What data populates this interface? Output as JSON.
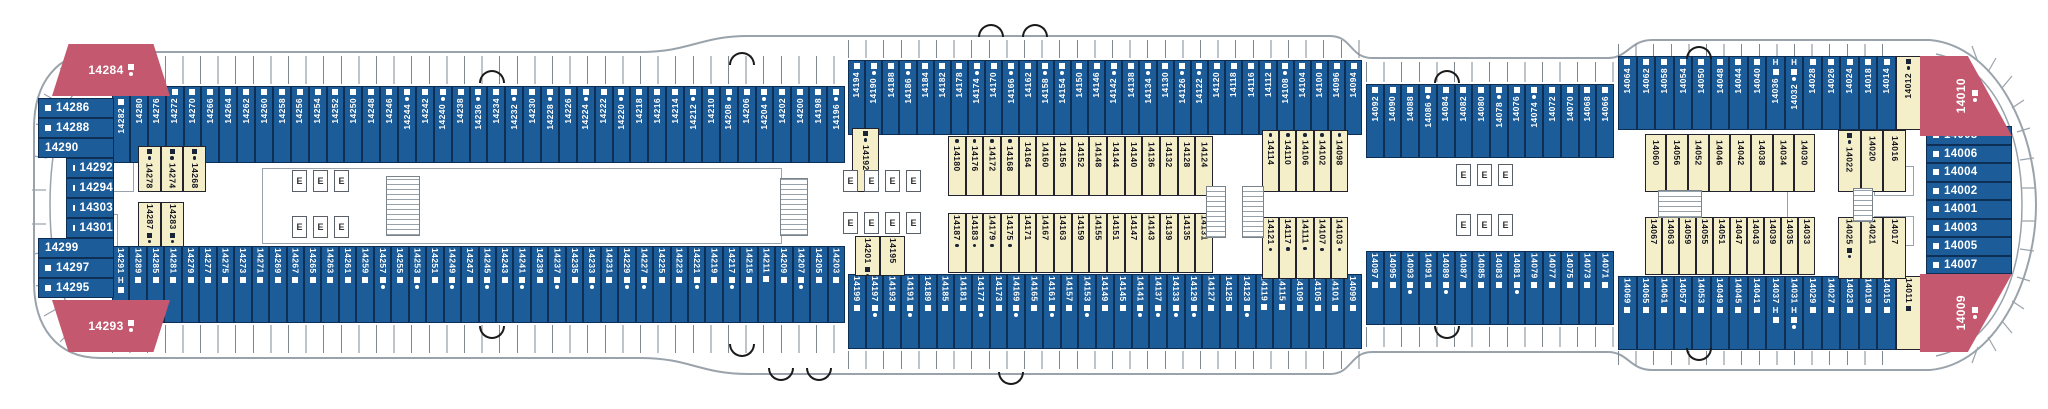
{
  "palette": {
    "cabin_blue": "#1c5c99",
    "cabin_inside_yellow": "#f4efc9",
    "suite_red": "#c4586f",
    "outline_gray": "#9aa3ab",
    "text_dark": "#14141e",
    "text_light": "#ffffff"
  },
  "deck": {
    "strips": [
      {
        "name": "top-outer-left-band",
        "x": 112,
        "y": 86,
        "w": 733,
        "h": 77,
        "orient": "v-up",
        "style": "blue",
        "mk": "start",
        "cells": [
          "14282|H",
          "14280",
          "14276",
          "14272",
          "14270",
          "14266",
          "14264",
          "14262",
          "14260",
          "14258",
          "14256",
          "14254",
          "14252",
          "14250",
          "14248",
          "14246",
          "14244|d",
          "14242",
          "14240|d",
          "14238",
          "14236|d",
          "14234",
          "14232|d",
          "14230",
          "14228|d",
          "14226",
          "14224|d",
          "14222",
          "14220|d",
          "14218",
          "14216",
          "14214",
          "14212|d",
          "14210",
          "14208|d",
          "14206",
          "14204|d",
          "14202",
          "14200",
          "14198",
          "14196|d"
        ]
      },
      {
        "name": "top-outer-mid-band",
        "x": 848,
        "y": 60,
        "w": 514,
        "h": 75,
        "orient": "v-up",
        "style": "blue",
        "mk": "start",
        "cells": [
          "14194",
          "14190|d",
          "14188",
          "14186|d",
          "14184",
          "14182",
          "14178",
          "14174|d",
          "14170",
          "14166|d",
          "14162",
          "14158|d",
          "14154|d",
          "14150",
          "14146",
          "14142|d",
          "14138",
          "14134|d",
          "14130",
          "14126|d",
          "14122|d",
          "14120",
          "14118",
          "14116",
          "14112",
          "14108|d",
          "14104",
          "14100",
          "14096",
          "14094"
        ]
      },
      {
        "name": "top-outer-narrow-band",
        "x": 1366,
        "y": 84,
        "w": 248,
        "h": 74,
        "orient": "v-up",
        "style": "blue",
        "mk": "start",
        "cells": [
          "14092",
          "14090",
          "14088",
          "14086|d",
          "14084",
          "14082",
          "14080",
          "14078|d",
          "14076",
          "14074|d",
          "14072",
          "14070",
          "14068",
          "14066"
        ]
      },
      {
        "name": "top-outer-fwd-band",
        "x": 1618,
        "y": 56,
        "w": 278,
        "h": 74,
        "orient": "v-up",
        "style": "blue",
        "mk": "start",
        "cells": [
          "14064",
          "14062",
          "14058",
          "14054",
          "14050",
          "14048",
          "14044",
          "14040",
          "14036|H",
          "14032|Hd",
          "14028",
          "14026",
          "14024",
          "14018",
          "14014"
        ]
      },
      {
        "name": "top-fwd-yellow-cabin",
        "x": 1896,
        "y": 56,
        "w": 25,
        "h": 74,
        "orient": "v-up",
        "style": "yellow",
        "mk": "start",
        "cells": [
          "14012|sd"
        ]
      },
      {
        "name": "top-inner-14192",
        "x": 852,
        "y": 128,
        "w": 27,
        "h": 64,
        "orient": "v-down",
        "style": "yellow",
        "mk": "start",
        "cells": [
          "14192|sd"
        ]
      },
      {
        "name": "top-inner-mid-a",
        "x": 948,
        "y": 136,
        "w": 265,
        "h": 60,
        "orient": "v-down",
        "style": "yellow",
        "mk": "start",
        "cells": [
          "14180|d",
          "14176|d",
          "14172|d",
          "14168|d",
          "14164",
          "14160",
          "14156",
          "14152",
          "14148",
          "14144",
          "14140",
          "14136",
          "14132",
          "14128",
          "14124"
        ]
      },
      {
        "name": "top-inner-mid-b",
        "x": 1262,
        "y": 130,
        "w": 86,
        "h": 62,
        "orient": "v-down",
        "style": "yellow",
        "mk": "start",
        "cells": [
          "14114|d",
          "14110|d",
          "14106|d",
          "14102|d",
          "14098|d"
        ]
      },
      {
        "name": "top-inner-fwd-a",
        "x": 1645,
        "y": 134,
        "w": 170,
        "h": 58,
        "orient": "v-down",
        "style": "yellow",
        "mk": "start",
        "cells": [
          "14060",
          "14056",
          "14052",
          "14046",
          "14042",
          "14038",
          "14034",
          "14030"
        ]
      },
      {
        "name": "top-inner-fwd-b",
        "x": 1838,
        "y": 130,
        "w": 68,
        "h": 62,
        "orient": "v-down",
        "style": "yellow",
        "mk": "start",
        "cells": [
          "14022|sd",
          "14020",
          "14016"
        ]
      },
      {
        "name": "aft-inner-top-cluster",
        "x": 138,
        "y": 146,
        "w": 68,
        "h": 46,
        "orient": "v-down",
        "style": "yellow",
        "mk": "start",
        "cells": [
          "14278|sd",
          "14274|sd",
          "14268|sd"
        ]
      },
      {
        "name": "aft-inner-bottom-cluster",
        "x": 138,
        "y": 202,
        "w": 46,
        "h": 46,
        "orient": "v-down",
        "style": "yellow",
        "mk": "end",
        "cells": [
          "14287|sd",
          "14283|sd"
        ]
      },
      {
        "name": "bottom-outer-left-band",
        "x": 112,
        "y": 246,
        "w": 733,
        "h": 77,
        "orient": "v-down",
        "style": "blue",
        "mk": "end",
        "cells": [
          "14291|H",
          "14289",
          "14285",
          "14281",
          "14279",
          "14277",
          "14275",
          "14273",
          "14271",
          "14269",
          "14267",
          "14265",
          "14263",
          "14261",
          "14259",
          "14257|d",
          "14255",
          "14253|d",
          "14251",
          "14249|d",
          "14247",
          "14245|d",
          "14243",
          "14241|d",
          "14239",
          "14237|d",
          "14235",
          "14233|d",
          "14231",
          "14229|d",
          "14227|d",
          "14225",
          "14223",
          "14221|d",
          "14219",
          "14217|d",
          "14215",
          "14211",
          "14209",
          "14207|d",
          "14205",
          "14203"
        ]
      },
      {
        "name": "bottom-outer-mid-band",
        "x": 848,
        "y": 274,
        "w": 514,
        "h": 75,
        "orient": "v-down",
        "style": "blue",
        "mk": "end",
        "cells": [
          "14199",
          "14197|d",
          "14193",
          "14191|d",
          "14189",
          "14185",
          "14181",
          "14177|d",
          "14173",
          "14169|d",
          "14165",
          "14161|d",
          "14157",
          "14153|d",
          "14149",
          "14145",
          "14141|d",
          "14137|d",
          "14133|d",
          "14129|d",
          "14127",
          "14125",
          "14123|d",
          "14119",
          "14115",
          "14109",
          "14105",
          "14101",
          "14099"
        ]
      },
      {
        "name": "bottom-outer-narrow-band",
        "x": 1366,
        "y": 251,
        "w": 248,
        "h": 74,
        "orient": "v-down",
        "style": "blue",
        "mk": "end",
        "cells": [
          "14097",
          "14095",
          "14093|d",
          "14091",
          "14089|d",
          "14087",
          "14085",
          "14083",
          "14081|d",
          "14079",
          "14077",
          "14075",
          "14073",
          "14071"
        ]
      },
      {
        "name": "bottom-outer-fwd-band",
        "x": 1618,
        "y": 276,
        "w": 278,
        "h": 74,
        "orient": "v-down",
        "style": "blue",
        "mk": "end",
        "cells": [
          "14069",
          "14065",
          "14061",
          "14057",
          "14053",
          "14049",
          "14045",
          "14041",
          "14037|H",
          "14031|Hd",
          "14029",
          "14027",
          "14023",
          "14019",
          "14015"
        ]
      },
      {
        "name": "bottom-fwd-yellow-cabin",
        "x": 1896,
        "y": 276,
        "w": 25,
        "h": 74,
        "orient": "v-down",
        "style": "yellow",
        "mk": "end",
        "cells": [
          "14011|s"
        ]
      },
      {
        "name": "bottom-inner-14201",
        "x": 855,
        "y": 236,
        "w": 50,
        "h": 40,
        "orient": "v-down",
        "style": "yellow",
        "mk": "end",
        "cells": [
          "14201|sd",
          "14195"
        ]
      },
      {
        "name": "bottom-inner-mid-a",
        "x": 948,
        "y": 213,
        "w": 265,
        "h": 60,
        "orient": "v-down",
        "style": "yellow",
        "mk": "end",
        "cells": [
          "14187|d",
          "14183|d",
          "14179|d",
          "14175|d",
          "14171",
          "14167",
          "14163",
          "14159",
          "14155",
          "14151",
          "14147",
          "14143",
          "14139",
          "14135",
          "14131"
        ]
      },
      {
        "name": "bottom-inner-mid-b",
        "x": 1262,
        "y": 217,
        "w": 86,
        "h": 62,
        "orient": "v-down",
        "style": "yellow",
        "mk": "end",
        "cells": [
          "14121|d",
          "14117|d",
          "14111|d",
          "14107|d",
          "14103|d"
        ]
      },
      {
        "name": "bottom-inner-fwd-a",
        "x": 1645,
        "y": 217,
        "w": 170,
        "h": 58,
        "orient": "v-down",
        "style": "yellow",
        "mk": "end",
        "cells": [
          "14067",
          "14063",
          "14059",
          "14055",
          "14051",
          "14047",
          "14043",
          "14039",
          "14035",
          "14033"
        ]
      },
      {
        "name": "bottom-inner-fwd-b",
        "x": 1838,
        "y": 217,
        "w": 68,
        "h": 62,
        "orient": "v-down",
        "style": "yellow",
        "mk": "end",
        "cells": [
          "14025|sd",
          "14021",
          "14017"
        ]
      }
    ],
    "columns": [
      {
        "name": "aft-end-column",
        "x": 38,
        "y": 98,
        "w": 76,
        "rowH": 20,
        "cells": [
          "14286|s",
          "14288|s",
          "14290",
          "14292|si",
          "14294|si",
          "14303|si",
          "14301|si",
          "14299",
          "14297|s",
          "14295|s"
        ]
      },
      {
        "name": "fwd-end-column",
        "x": 1926,
        "y": 126,
        "w": 86,
        "rowH": 18.5,
        "cells": [
          "14008|s",
          "14006|s",
          "14004|s",
          "14002|s",
          "14001|s",
          "14003|s",
          "14005|s",
          "14007|s"
        ]
      }
    ],
    "suites": [
      {
        "n": "14284",
        "flags": "sd",
        "x": 52,
        "y": 44,
        "w": 118,
        "h": 52,
        "orient": "h",
        "clip": "polygon(14% 0,86% 0,100% 100%,0 100%)"
      },
      {
        "n": "14293",
        "flags": "sd",
        "x": 52,
        "y": 300,
        "w": 118,
        "h": 52,
        "orient": "h",
        "clip": "polygon(0 0,100% 0,86% 100%,14% 100%)"
      },
      {
        "n": "14010",
        "flags": "sd",
        "x": 1920,
        "y": 56,
        "w": 92,
        "h": 80,
        "orient": "v",
        "clip": "polygon(0 0,52% 0,100% 100%,0 100%)"
      },
      {
        "n": "14009",
        "flags": "sd",
        "x": 1920,
        "y": 274,
        "w": 92,
        "h": 78,
        "orient": "v",
        "clip": "polygon(0 0,100% 0,52% 100%,0 100%)"
      }
    ],
    "facilities": {
      "elevator_label": "E",
      "elevator_banks": [
        {
          "x": 292,
          "y": 170,
          "n": 3
        },
        {
          "x": 292,
          "y": 216,
          "n": 3
        },
        {
          "x": 843,
          "y": 170,
          "n": 4
        },
        {
          "x": 843,
          "y": 212,
          "n": 4
        },
        {
          "x": 1456,
          "y": 164,
          "n": 3
        },
        {
          "x": 1456,
          "y": 214,
          "n": 3
        }
      ],
      "stairs": [
        [
          386,
          176,
          34,
          60
        ],
        [
          780,
          178,
          28,
          58
        ],
        [
          1206,
          186,
          20,
          52
        ],
        [
          1242,
          186,
          22,
          52
        ],
        [
          1658,
          190,
          44,
          28
        ],
        [
          1853,
          188,
          20,
          34
        ]
      ],
      "rooms": [
        [
          262,
          168,
          520,
          76
        ],
        [
          1700,
          186,
          88,
          44
        ],
        [
          1874,
          166,
          40,
          30
        ],
        [
          1874,
          216,
          40,
          30
        ],
        [
          88,
          148,
          46,
          44
        ],
        [
          88,
          214,
          30,
          44
        ]
      ],
      "arcs_top": [
        [
          479,
          70
        ],
        [
          729,
          52
        ],
        [
          1434,
          70
        ],
        [
          1686,
          46
        ],
        [
          978,
          24
        ],
        [
          1022,
          24
        ]
      ],
      "arcs_bottom": [
        [
          479,
          326
        ],
        [
          729,
          344
        ],
        [
          1434,
          326
        ],
        [
          1686,
          348
        ],
        [
          768,
          368
        ],
        [
          806,
          368
        ],
        [
          998,
          372
        ]
      ],
      "ticks": [
        [
          112,
          56,
          733,
          28
        ],
        [
          848,
          40,
          514,
          18
        ],
        [
          1366,
          62,
          248,
          20
        ],
        [
          1618,
          44,
          278,
          14
        ],
        [
          112,
          325,
          733,
          28
        ],
        [
          848,
          351,
          514,
          18
        ],
        [
          1366,
          327,
          248,
          20
        ],
        [
          1618,
          351,
          278,
          14
        ]
      ]
    }
  }
}
